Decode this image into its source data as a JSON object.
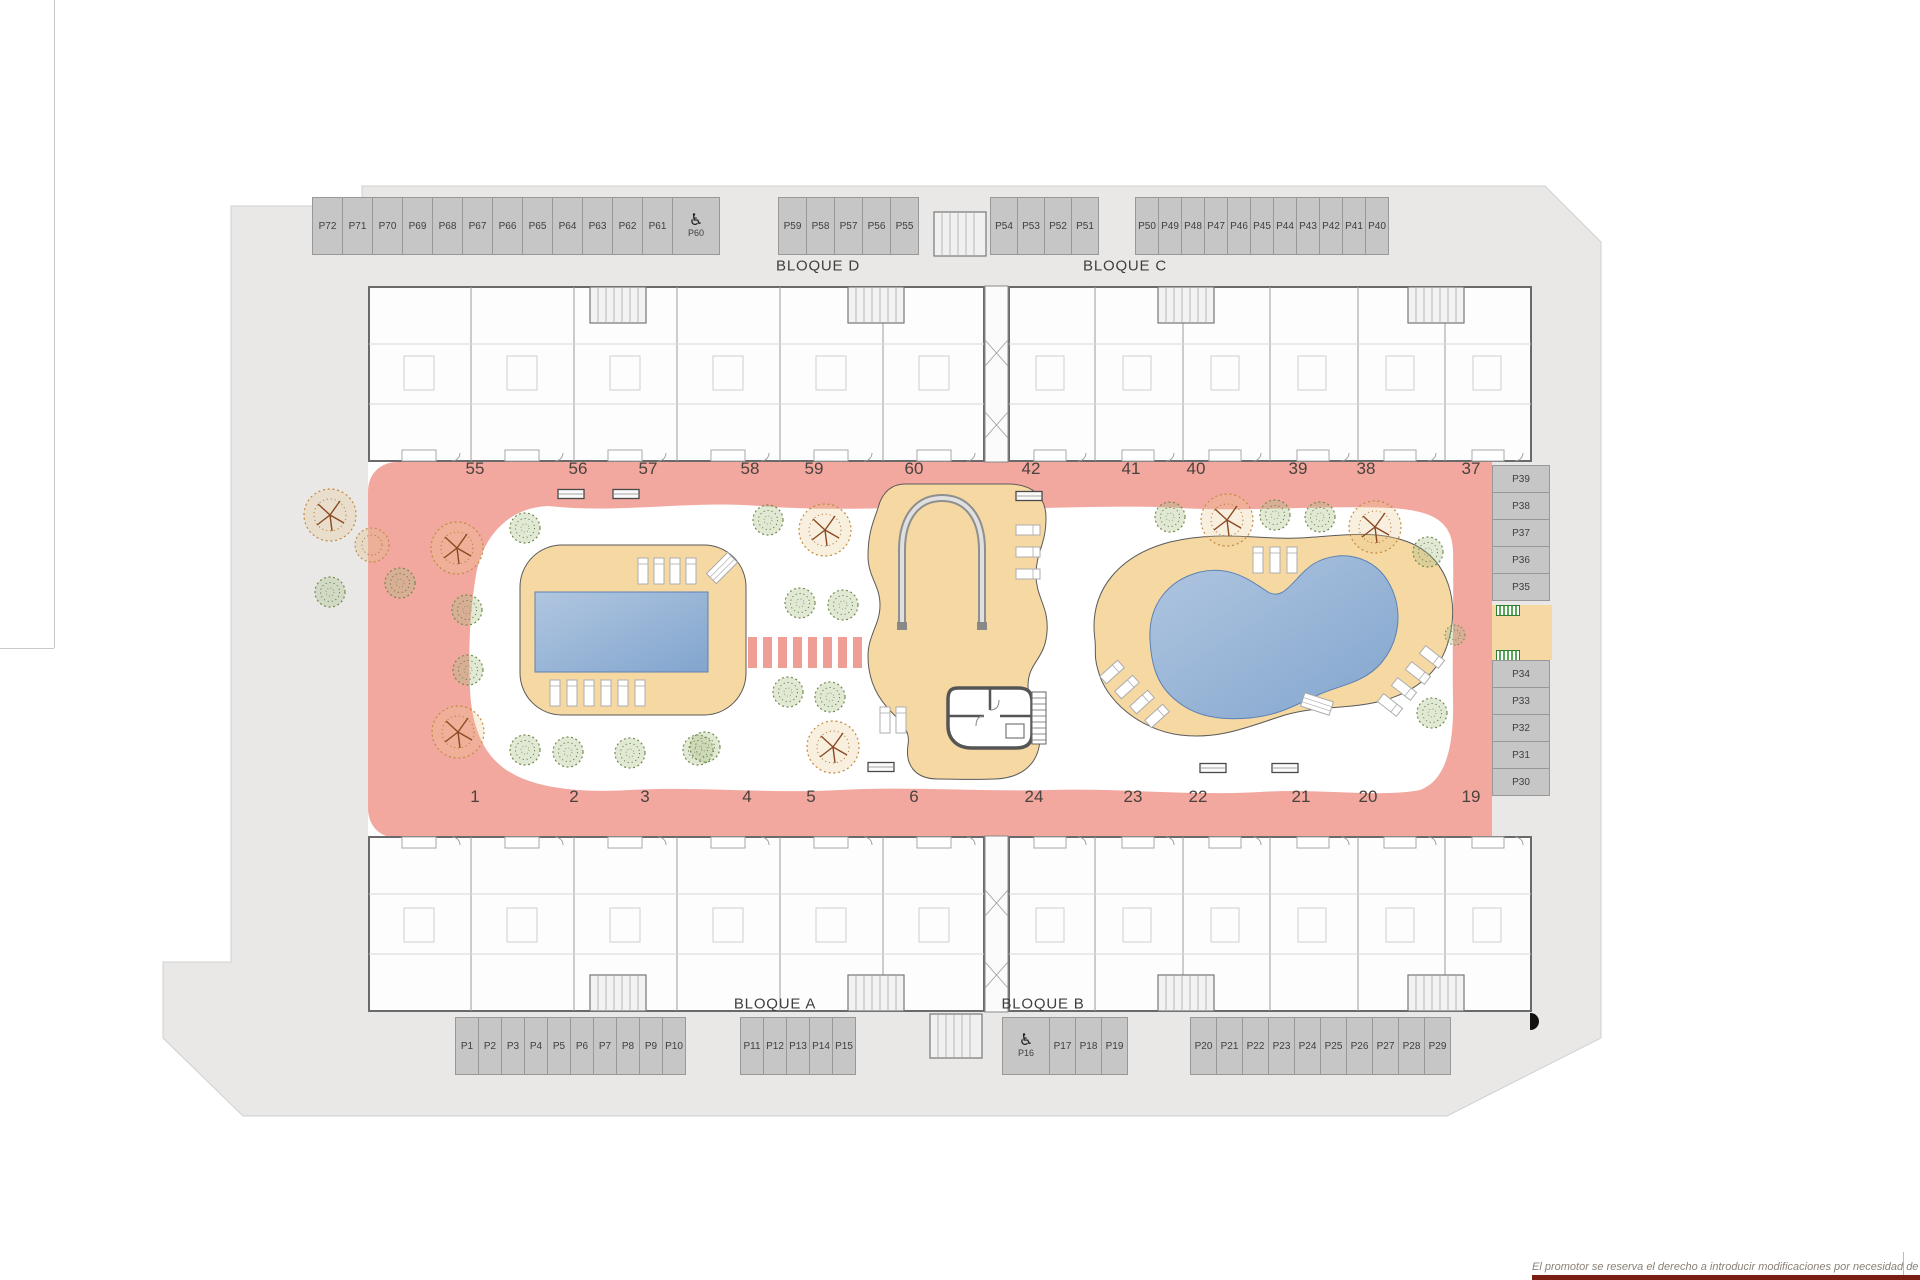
{
  "blocks": {
    "a": "BLOQUE A",
    "b": "BLOQUE B",
    "c": "BLOQUE C",
    "d": "BLOQUE D"
  },
  "units": {
    "top": [
      "55",
      "56",
      "57",
      "58",
      "59",
      "60",
      "42",
      "41",
      "40",
      "39",
      "38",
      "37"
    ],
    "bottom": [
      "1",
      "2",
      "3",
      "4",
      "5",
      "6",
      "24",
      "23",
      "22",
      "21",
      "20",
      "19"
    ]
  },
  "parking": {
    "top_left": [
      "P72",
      "P71",
      "P70",
      "P69",
      "P68",
      "P67",
      "P66",
      "P65",
      "P64",
      "P63",
      "P62",
      "P61"
    ],
    "top_left_handicap": "P60",
    "top_mid_left": [
      "P59",
      "P58",
      "P57",
      "P56",
      "P55"
    ],
    "top_mid_right": [
      "P54",
      "P53",
      "P52",
      "P51"
    ],
    "top_right": [
      "P50",
      "P49",
      "P48",
      "P47",
      "P46",
      "P45",
      "P44",
      "P43",
      "P42",
      "P41",
      "P40"
    ],
    "right_upper": [
      "P39",
      "P38",
      "P37",
      "P36",
      "P35"
    ],
    "right_lower": [
      "P34",
      "P33",
      "P32",
      "P31",
      "P30"
    ],
    "bottom_left": [
      "P1",
      "P2",
      "P3",
      "P4",
      "P5",
      "P6",
      "P7",
      "P8",
      "P9",
      "P10"
    ],
    "bottom_mid": [
      "P11",
      "P12",
      "P13",
      "P14",
      "P15"
    ],
    "bottom_handicap": "P16",
    "bottom_mid_right": [
      "P17",
      "P18",
      "P19"
    ],
    "bottom_right": [
      "P20",
      "P21",
      "P22",
      "P23",
      "P24",
      "P25",
      "P26",
      "P27",
      "P28",
      "P29"
    ]
  },
  "icons": {
    "handicap": "♿"
  },
  "footer": {
    "disclaimer": "El promotor se reserva el derecho a introducir modificaciones por necesidad de índole técnica o legal"
  },
  "colors": {
    "site_gray": "#e9e8e7",
    "stall_gray": "#c6c6c6",
    "path_pink": "#f2a79f",
    "crosswalk_pink": "#ef9e95",
    "deck_beige": "#f6d8a3",
    "pool_blue_light": "#b0c6e0",
    "pool_blue_dark": "#82a5ce",
    "tree_green": "#6f8a4a",
    "tree_orange": "#bd8a44"
  }
}
